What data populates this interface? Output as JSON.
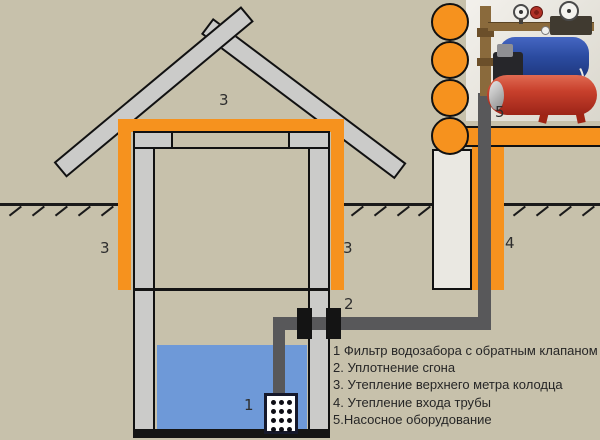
{
  "diagram": {
    "description": "Схема утепления колодца с насосным оборудованием",
    "markers": {
      "intake_filter": "1",
      "pipe_union": "2",
      "roof_insulation": "3",
      "left_insulation": "3",
      "right_insulation": "3",
      "pipe_entry_insulation": "4",
      "pump_equipment": "5"
    },
    "legend": {
      "items": [
        "1 Фильтр водозабора с обратным клапаном",
        "2. Уплотнение сгона",
        "3. Утепление верхнего метра колодца",
        "4. Утепление входа трубы",
        "5.Насосное оборудование"
      ]
    },
    "colors": {
      "background": "#c7c1ab",
      "insulation_orange": "#f6921e",
      "frame_gray": "#cbcbc9",
      "outline_black": "#111111",
      "water_blue": "#6e99d8",
      "pipe_gray": "#58585a",
      "pump_blue": "#2b4ba0",
      "tank_red": "#b02a17",
      "brass": "#8a6a3c"
    }
  }
}
